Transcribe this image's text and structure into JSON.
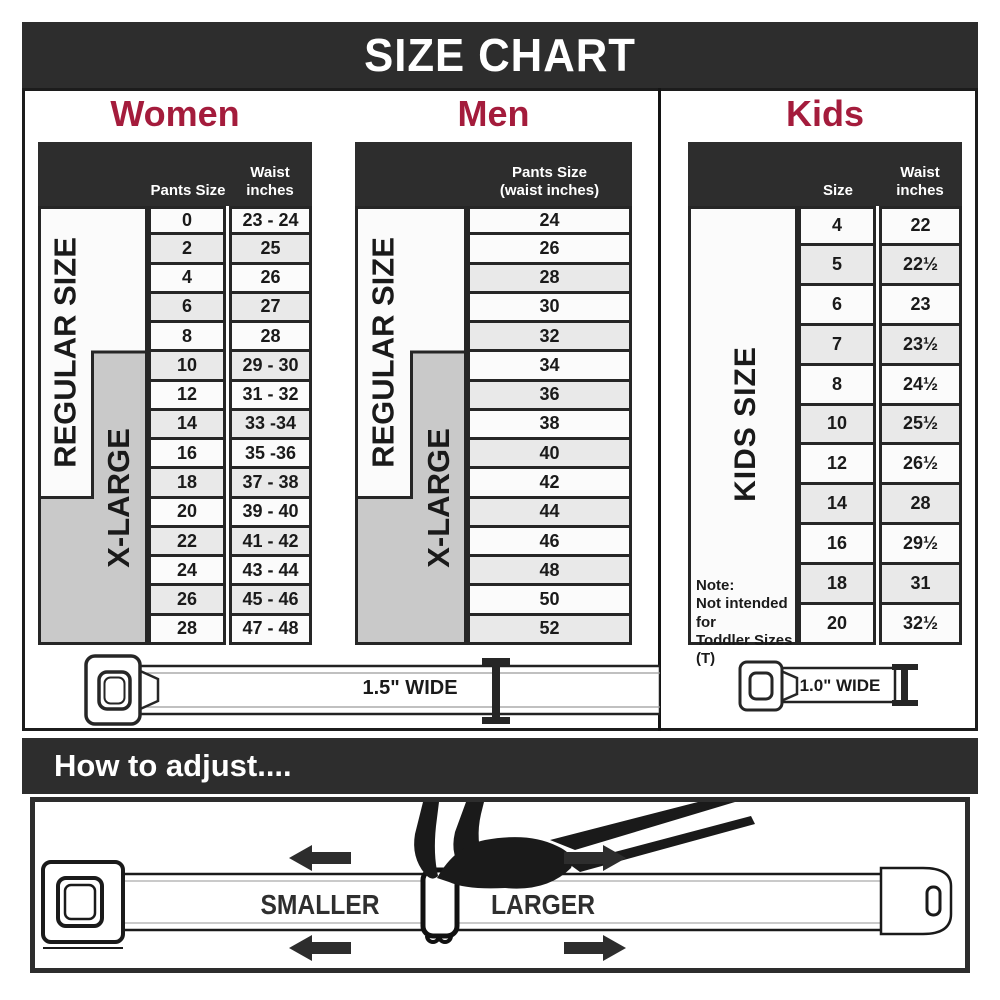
{
  "title": "SIZE CHART",
  "colors": {
    "dark_bar": "#2d2d2d",
    "heading_crimson": "#a41c3c",
    "xlarge_gray": "#c9c9c9",
    "row_shade": "#e9e9e9"
  },
  "sections": {
    "women": {
      "heading": "Women",
      "col1_header": "Pants Size",
      "col2_header_l1": "Waist",
      "col2_header_l2": "inches",
      "regular_label": "REGULAR SIZE",
      "xlarge_label": "X-LARGE",
      "rows": [
        [
          "0",
          "23 - 24"
        ],
        [
          "2",
          "25"
        ],
        [
          "4",
          "26"
        ],
        [
          "6",
          "27"
        ],
        [
          "8",
          "28"
        ],
        [
          "10",
          "29 - 30"
        ],
        [
          "12",
          "31 - 32"
        ],
        [
          "14",
          "33 -34"
        ],
        [
          "16",
          "35 -36"
        ],
        [
          "18",
          "37 - 38"
        ],
        [
          "20",
          "39 - 40"
        ],
        [
          "22",
          "41 - 42"
        ],
        [
          "24",
          "43 - 44"
        ],
        [
          "26",
          "45 - 46"
        ],
        [
          "28",
          "47 - 48"
        ]
      ]
    },
    "men": {
      "heading": "Men",
      "col_header_l1": "Pants Size",
      "col_header_l2": "(waist inches)",
      "regular_label": "REGULAR SIZE",
      "xlarge_label": "X-LARGE",
      "rows": [
        "24",
        "26",
        "28",
        "30",
        "32",
        "34",
        "36",
        "38",
        "40",
        "42",
        "44",
        "46",
        "48",
        "50",
        "52"
      ]
    },
    "kids": {
      "heading": "Kids",
      "col1_header": "Size",
      "col2_header_l1": "Waist",
      "col2_header_l2": "inches",
      "side_label": "KIDS SIZE",
      "note_l1": "Note:",
      "note_l2": "Not intended for",
      "note_l3": "Toddler Sizes (T)",
      "rows": [
        [
          "4",
          "22"
        ],
        [
          "5",
          "22½"
        ],
        [
          "6",
          "23"
        ],
        [
          "7",
          "23½"
        ],
        [
          "8",
          "24½"
        ],
        [
          "10",
          "25½"
        ],
        [
          "12",
          "26½"
        ],
        [
          "14",
          "28"
        ],
        [
          "16",
          "29½"
        ],
        [
          "18",
          "31"
        ],
        [
          "20",
          "32½"
        ]
      ]
    }
  },
  "belts": {
    "adult_width_label": "1.5\" WIDE",
    "kids_width_label": "1.0\" WIDE"
  },
  "adjust": {
    "heading": "How to adjust....",
    "smaller_label": "SMALLER",
    "larger_label": "LARGER"
  }
}
